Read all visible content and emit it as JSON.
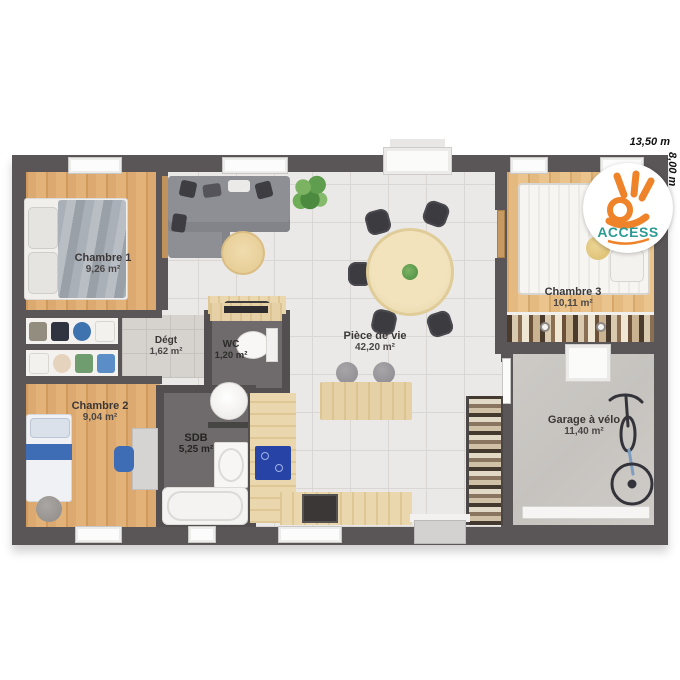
{
  "plan": {
    "type": "floor-plan",
    "rooms": [
      {
        "id": "chambre1",
        "name": "Chambre 1",
        "area": "9,26 m²"
      },
      {
        "id": "chambre2",
        "name": "Chambre 2",
        "area": "9,04 m²"
      },
      {
        "id": "chambre3",
        "name": "Chambre 3",
        "area": "10,11 m²"
      },
      {
        "id": "piece_de_vie",
        "name": "Pièce de vie",
        "area": "42,20 m²"
      },
      {
        "id": "degt",
        "name": "Dégt",
        "area": "1,62 m²"
      },
      {
        "id": "wc",
        "name": "WC",
        "area": "1,20 m²"
      },
      {
        "id": "sdb",
        "name": "SDB",
        "area": "5,25 m²"
      },
      {
        "id": "garage_velo",
        "name": "Garage à vélo",
        "area": "11,40 m²"
      }
    ]
  },
  "dimensions": {
    "width_label": "13,50 m",
    "height_label": "8,00 m"
  },
  "logo": {
    "brand": "ACCESS"
  },
  "colors": {
    "wall": "#5a5657",
    "wood_floor": "#dcaa70",
    "wood_floor_light": "#e4ba80",
    "tile_floor": "#ebe9e7",
    "bath_floor": "#6f6b6c",
    "garage_floor": "#cac7c3",
    "counter_wood": "#ead7ad",
    "cooktop_blue": "#2743a6",
    "chair_blue": "#3f6db5",
    "brand_orange": "#ef8329",
    "brand_teal": "#2b9b94"
  }
}
